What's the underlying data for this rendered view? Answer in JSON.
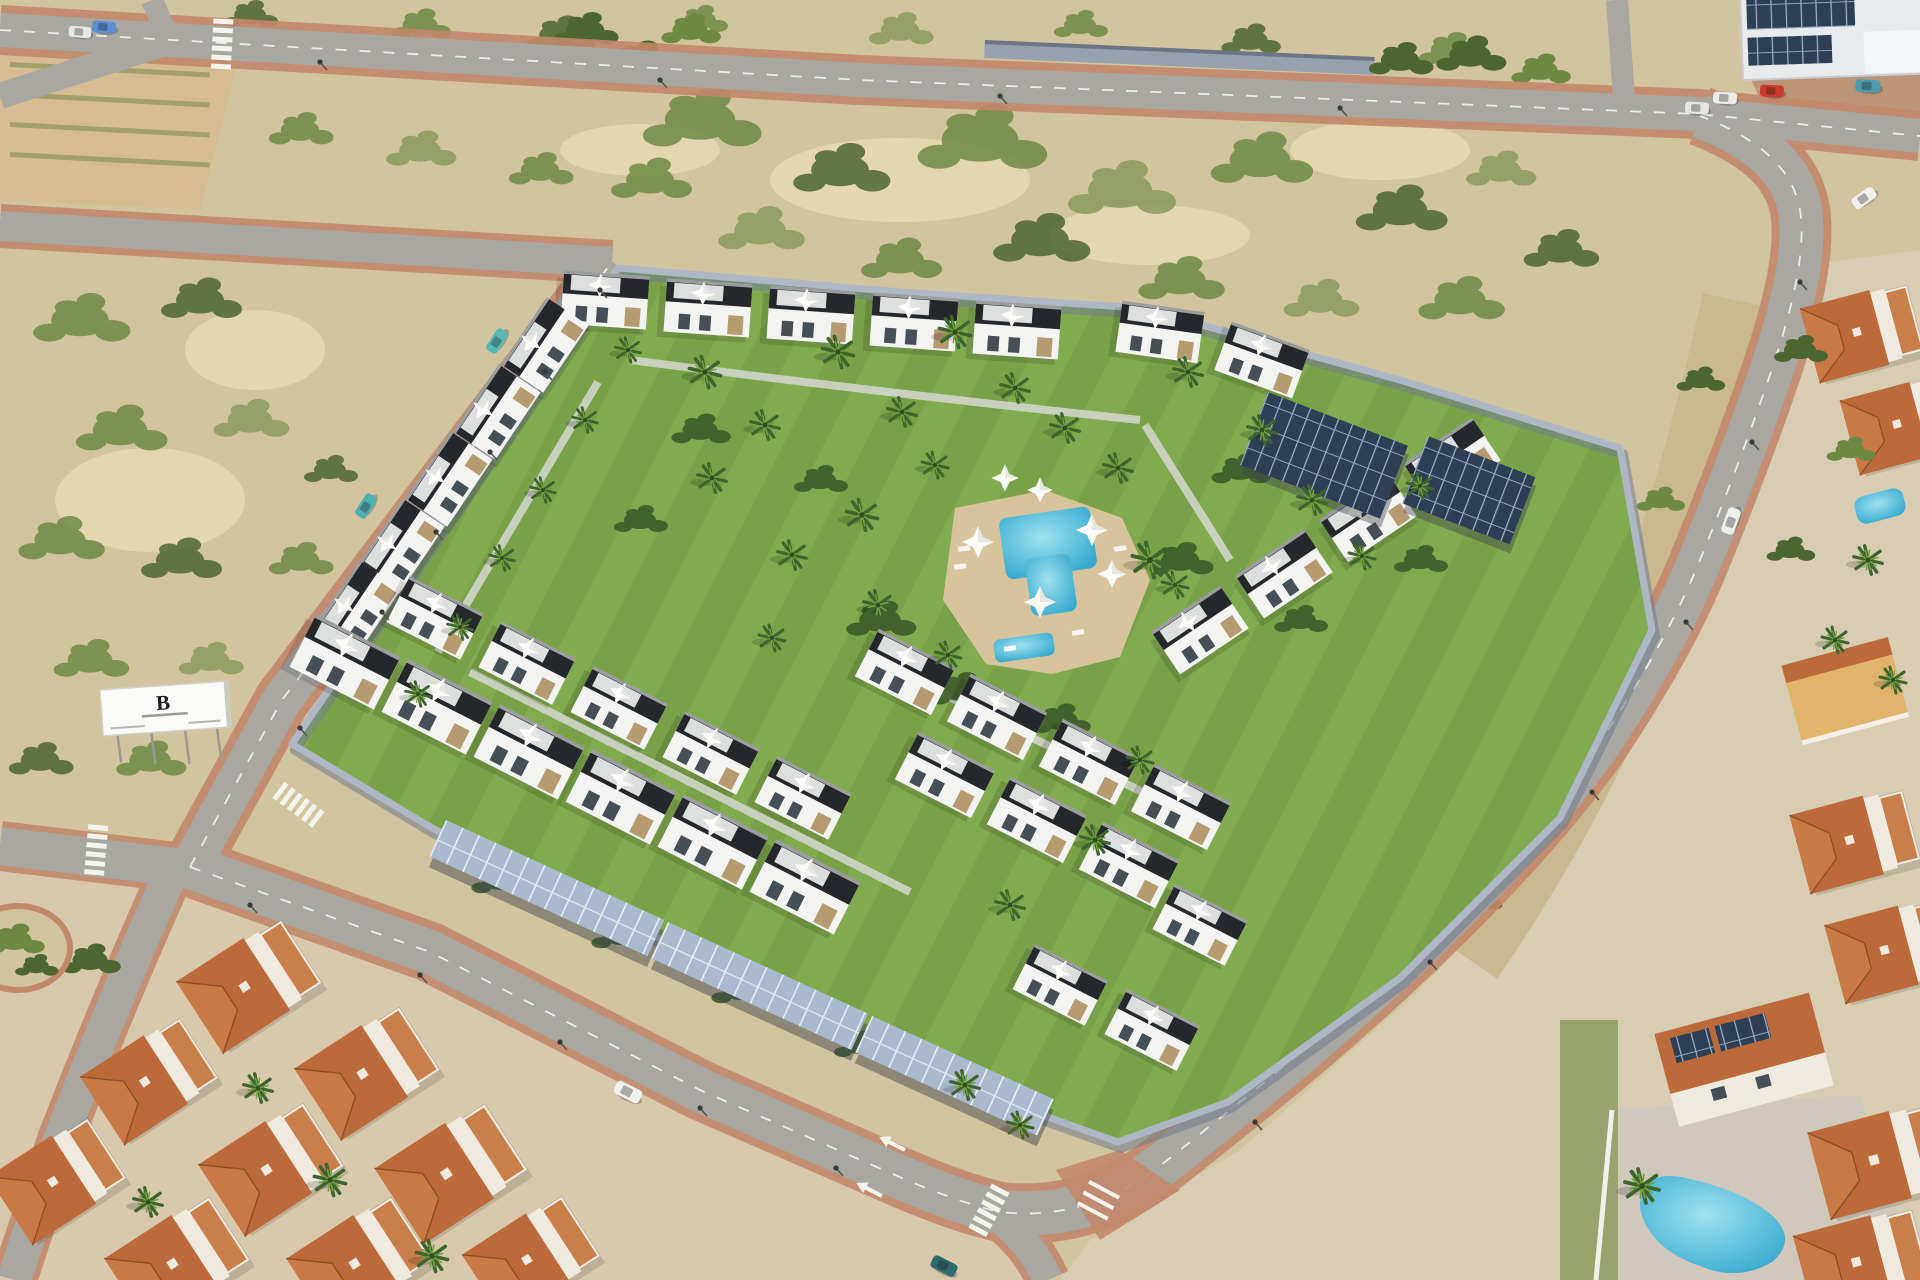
{
  "image": {
    "description": "Sunny aerial 3D render of a walled residential development: modern white townhouses with dark roof terraces arranged around a landscaped lawn garden with a central swimming pool, solar-panel carports along the boundary road, vacant scrubland plots to the north and west, an industrial hall at the top right, and an existing neighbourhood of terracotta-roofed houses with private pools to the south and east.",
    "lighting": "daylight, sun from the east"
  },
  "billboard": {
    "logo": "B"
  },
  "palette": {
    "sand": "#d2c49e",
    "sandLight": "#e8dcb4",
    "scrub1": "#6d8a43",
    "scrub2": "#4c662f",
    "scrub3": "#8a9a5b",
    "dirt": "#d8b98e",
    "road": "#a8a7a2",
    "sidewalk": "#c2886a",
    "marking": "#f4f4ef",
    "lawn": "#79a248",
    "lawnLight": "#8db656",
    "hedge": "#3d5b2b",
    "wall": "#aeb7c6",
    "wallShadow": "#6f7b8e",
    "building": "#f3f4f2",
    "buildingShade": "#dddfde",
    "trim": "#24272b",
    "glass": "#454f58",
    "stone": "#b69a70",
    "deck": "#d8c49c",
    "pool": "#35a9cf",
    "poolLight": "#9fe2ef",
    "carportPanel": "#a9bacf",
    "solarPanel": "#2e3f55",
    "tile": "#bc6a3a",
    "tileLight": "#d4854e",
    "terrace": "#c97f4a",
    "whiteWall": "#efeae0",
    "ditchSand": "#c9b78e",
    "groundSW": "#d8c8ac",
    "groundE": "#d8cdb2",
    "patio": "#cfc8bb",
    "industrialRoof": "#e8eaec"
  }
}
